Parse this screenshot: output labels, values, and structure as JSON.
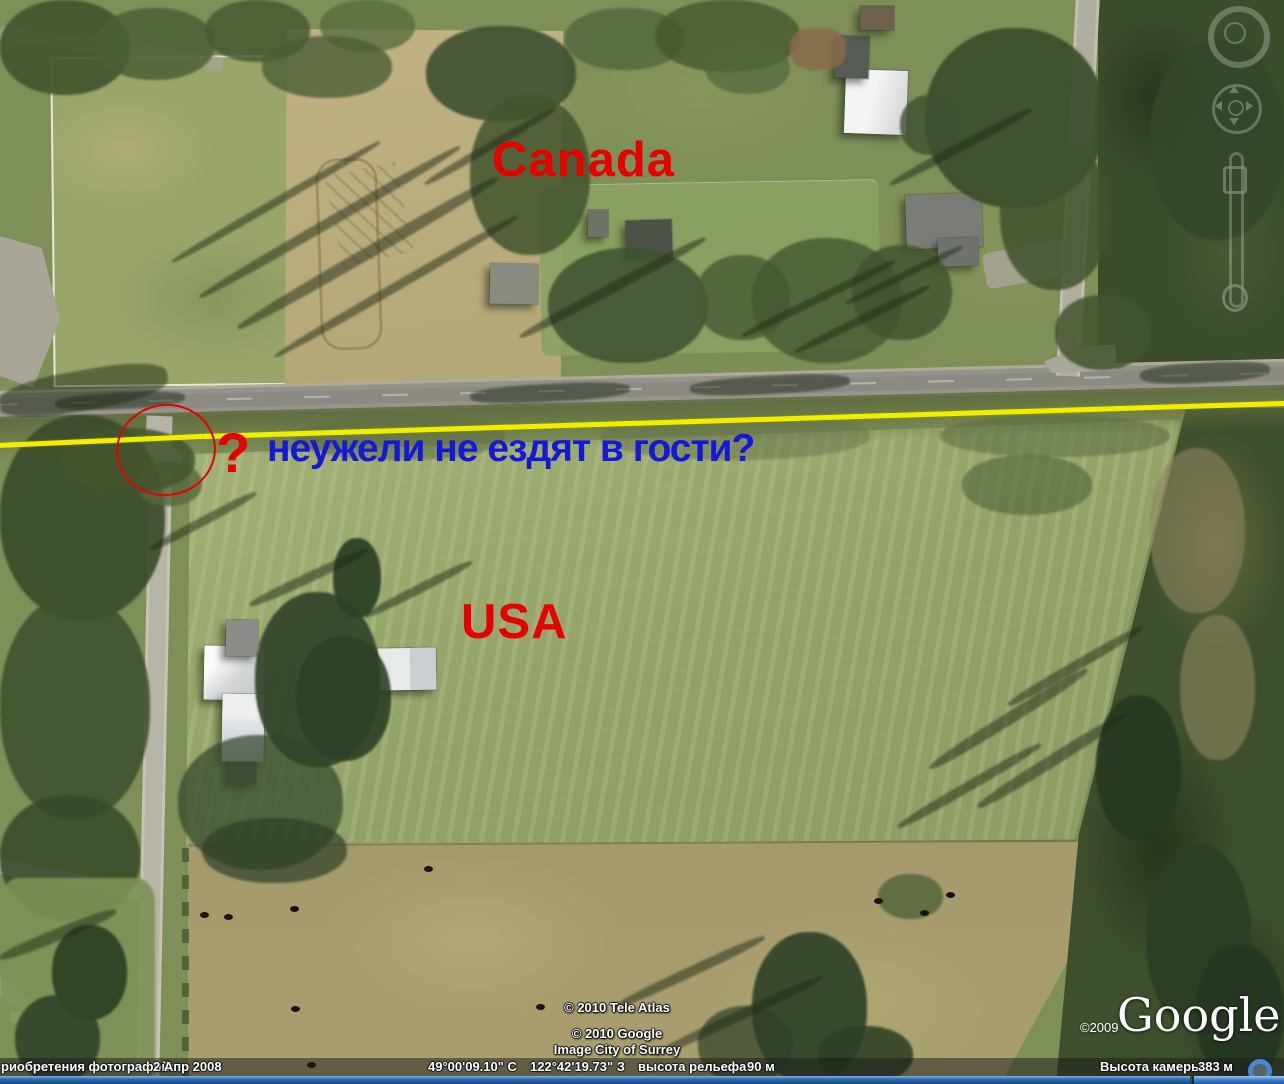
{
  "colors": {
    "anno_red": "#e60000",
    "anno_blue": "#1618d8",
    "border_yellow": "#f2ee00"
  },
  "annotations": {
    "canada": "Canada",
    "usa": "USA",
    "question_mark": "?",
    "question_text": "неужели не ездят в гости?"
  },
  "google_logo": {
    "year": "©2009",
    "text": "Google"
  },
  "copyright": {
    "line1": "© 2010 Tele Atlas",
    "line2": "© 2010 Google",
    "line3": "Image City of Surrey"
  },
  "status_bar": {
    "acq_label": "риобретения фотографий:",
    "acq_date": "2 Апр 2008",
    "lat": "49°00'09.10\" С",
    "lon": "122°42'19.73\" З",
    "terrain_label": "высота рельефа",
    "terrain_value": "90 м",
    "camera_label": "Высота камеры",
    "camera_value": "383 м"
  }
}
